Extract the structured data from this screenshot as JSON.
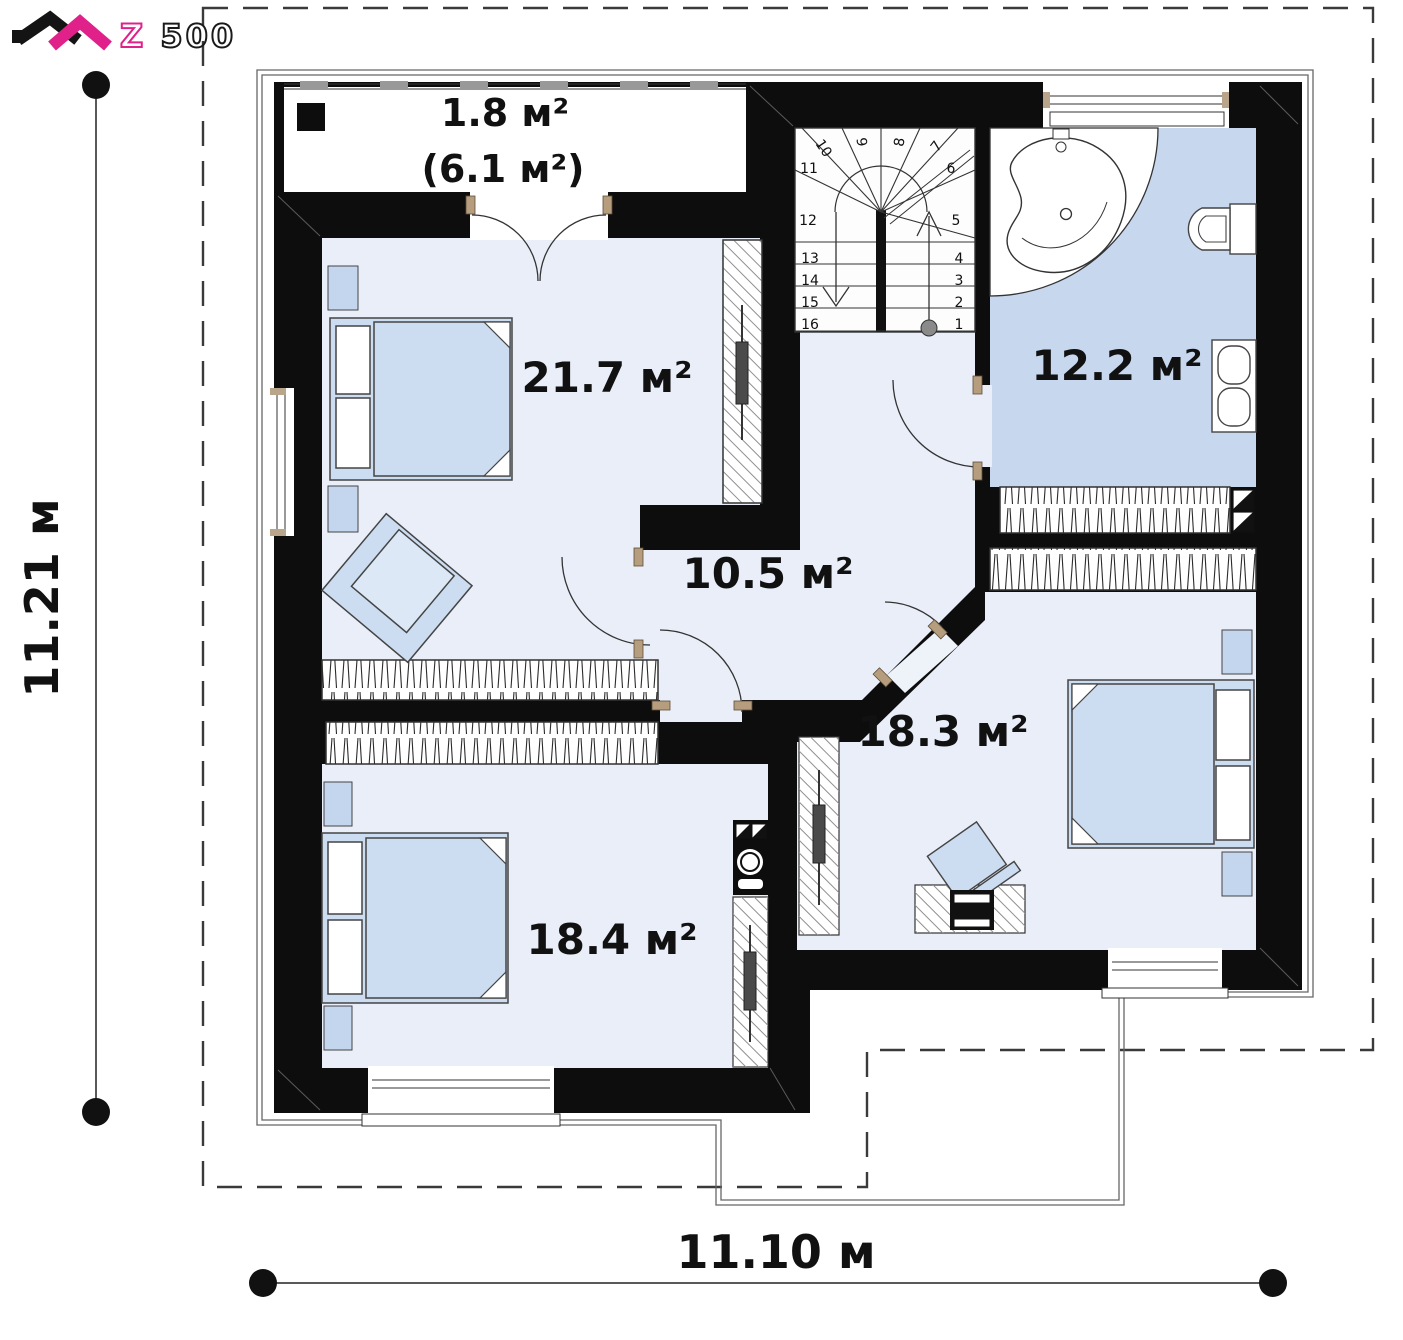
{
  "logo": {
    "z": "Z",
    "rest": "500"
  },
  "dimensions": {
    "left": "11.21 м",
    "bottom": "11.10 м"
  },
  "rooms": {
    "balcony_area": "1.8 м²",
    "balcony_total": "(6.1 м²)",
    "bedroom_top": "21.7 м²",
    "bathroom": "12.2 м²",
    "hall": "10.5 м²",
    "bedroom_right": "18.3 м²",
    "bedroom_bottom": "18.4 м²"
  },
  "stairs": {
    "numbers": [
      "1",
      "2",
      "3",
      "4",
      "5",
      "6",
      "7",
      "8",
      "9",
      "10",
      "11",
      "12",
      "13",
      "14",
      "15",
      "16"
    ]
  },
  "colors": {
    "accent_magenta": "#e0218a",
    "wall_black": "#0d0d0d",
    "floor_light": "#e9eef8",
    "bathroom_floor": "#c7d7ee",
    "furniture_blue": "#ccddf1"
  }
}
